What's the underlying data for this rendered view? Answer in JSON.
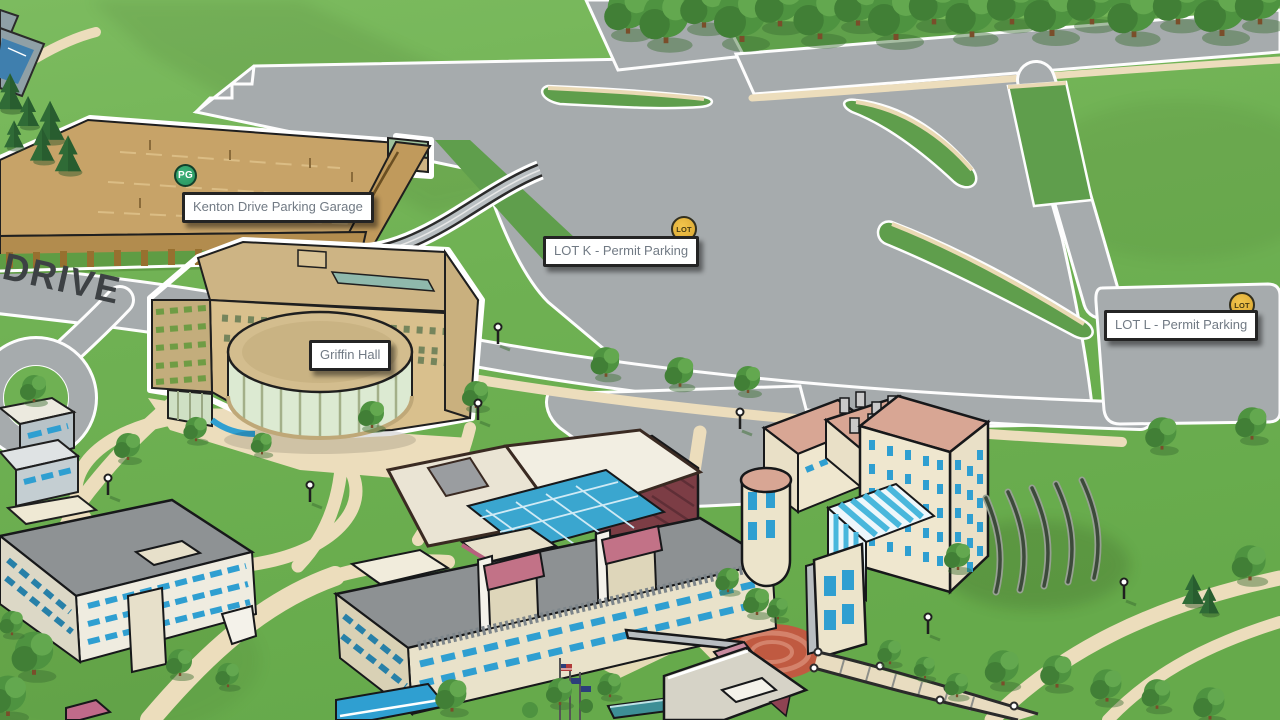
{
  "map": {
    "description": "Illustrated isometric university campus map",
    "road_label": "DRIVE",
    "markers": [
      {
        "id": "kenton-drive-parking-garage",
        "type": "parking-garage",
        "badge": "PG",
        "label": "Kenton Drive Parking Garage",
        "badge_color": "#2fa36c"
      },
      {
        "id": "griffin-hall",
        "type": "building",
        "badge": "",
        "label": "Griffin Hall",
        "badge_color": ""
      },
      {
        "id": "lot-k",
        "type": "parking-lot",
        "badge": "LOT",
        "label": "LOT K - Permit Parking",
        "badge_color": "#e8b93e"
      },
      {
        "id": "lot-l",
        "type": "parking-lot",
        "badge": "LOT",
        "label": "LOT L - Permit Parking",
        "badge_color": "#e8b93e"
      }
    ],
    "palette": {
      "grass": "#6fb153",
      "road": "#a6abad",
      "path": "#ecddbc",
      "label_text": "#717a84",
      "label_border": "#242424",
      "garage_roof": "#c7a368",
      "building_cream": "#e9e2ca",
      "accent_blue": "#2f9fd1",
      "accent_salmon": "#d8a694"
    }
  }
}
